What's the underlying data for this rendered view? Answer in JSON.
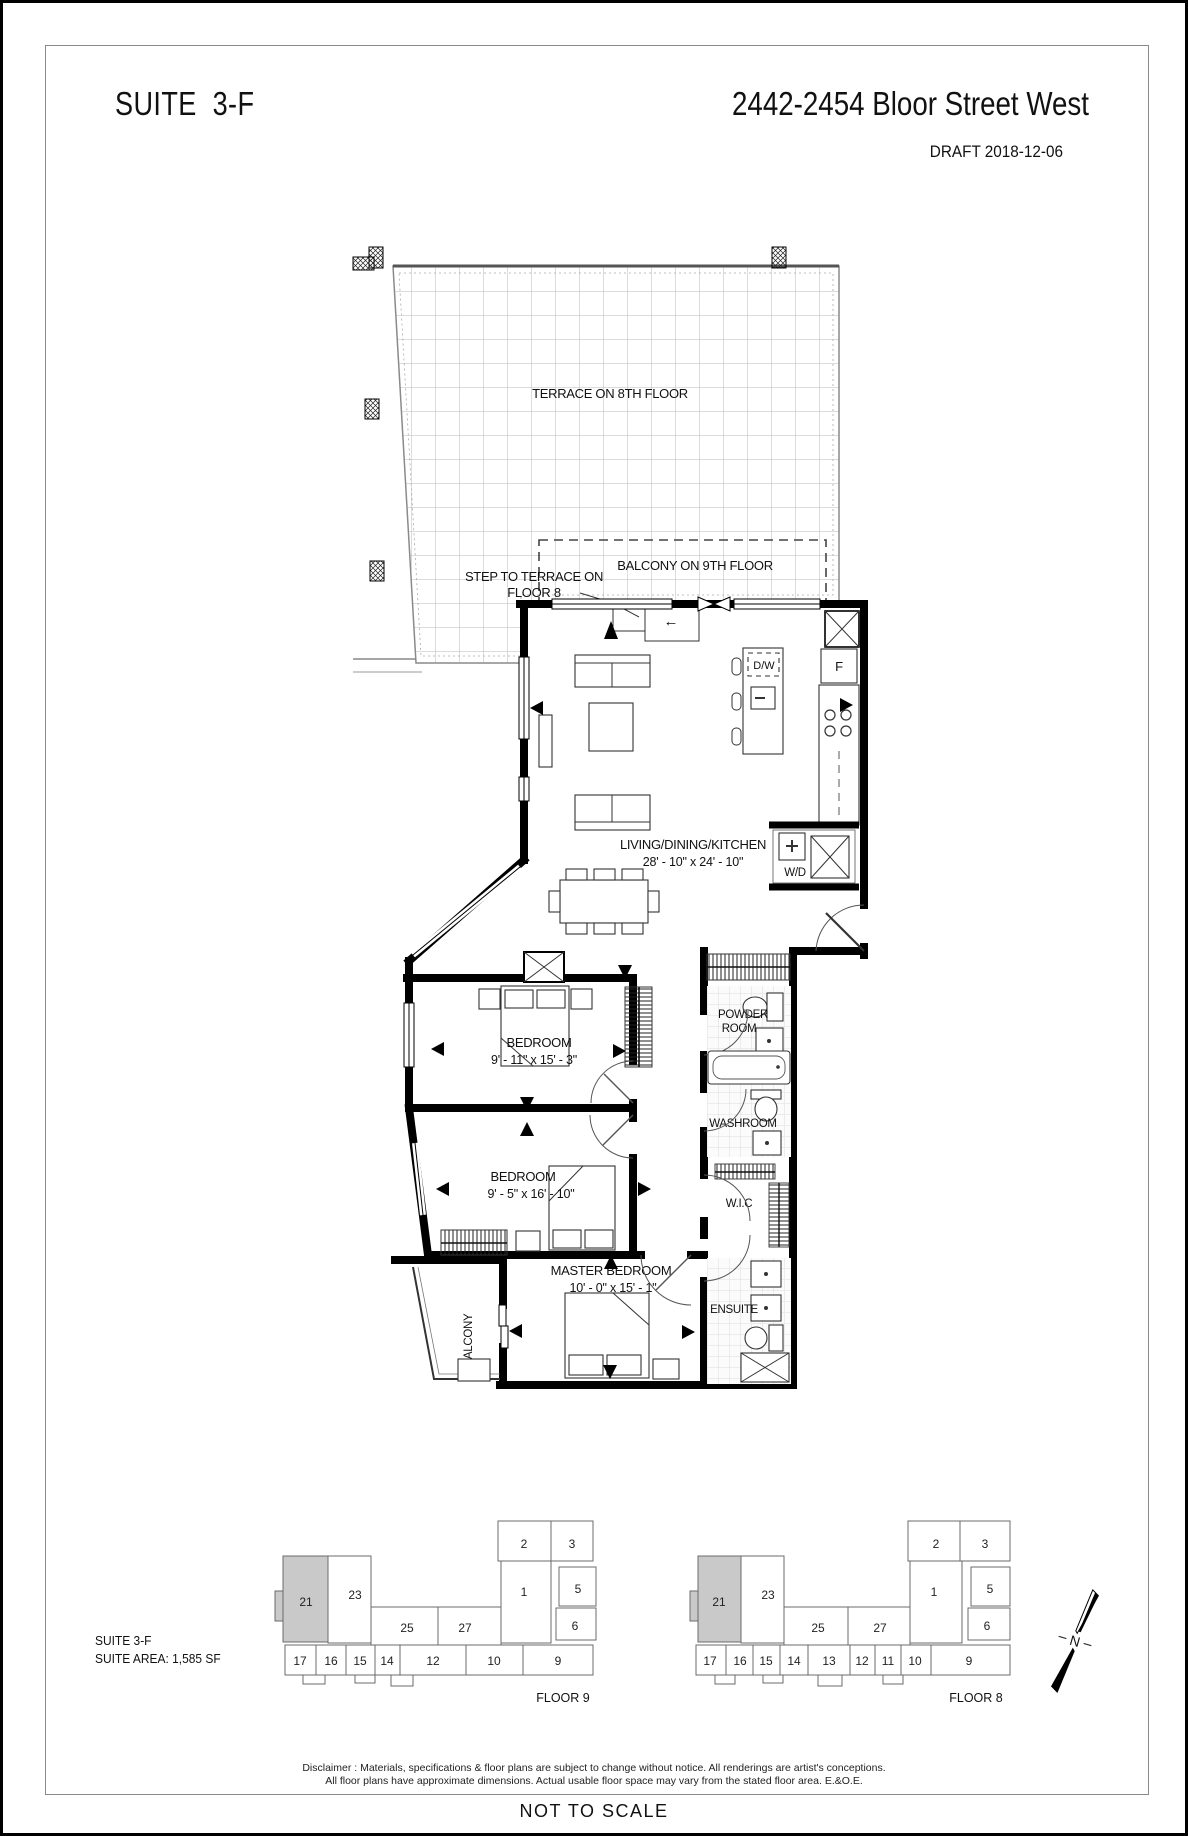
{
  "header": {
    "suite_title": "SUITE  3-F",
    "address": "2442-2454 Bloor Street West",
    "draft": "DRAFT 2018-12-06"
  },
  "plan": {
    "terrace": "TERRACE ON 8TH FLOOR",
    "balcony9": "BALCONY ON 9TH FLOOR",
    "step1": "STEP TO TERRACE ON",
    "step2": "FLOOR 8",
    "step_arrow": "←",
    "ldk": {
      "name": "LIVING/DINING/KITCHEN",
      "dims": "28' - 10\"  x  24' - 10\""
    },
    "bedroom1": {
      "name": "BEDROOM",
      "dims": "9' - 11\"  x  15' - 3\""
    },
    "bedroom2": {
      "name": "BEDROOM",
      "dims": "9' - 5\"  x  16' - 10\""
    },
    "master": {
      "name": "MASTER BEDROOM",
      "dims": "10' - 0\"  x  15' - 1\""
    },
    "powder1": "POWDER",
    "powder2": "ROOM",
    "washroom": "WASHROOM",
    "wic": "W.I.C",
    "ensuite": "ENSUITE",
    "balcony": "BALCONY",
    "dw": "D/W",
    "fridge": "F",
    "wd": "W/D"
  },
  "footer": {
    "suite": "SUITE 3-F",
    "area": "SUITE AREA: 1,585 SF",
    "highlight_color": "#c9c9c9",
    "north": "N",
    "floor9": {
      "label": "FLOOR 9",
      "units": {
        "u2": "2",
        "u3": "3",
        "u1": "1",
        "u5": "5",
        "u6": "6",
        "u21": "21",
        "u23": "23",
        "u25": "25",
        "u27": "27",
        "u17": "17",
        "u16": "16",
        "u15": "15",
        "u14": "14",
        "u12": "12",
        "u10": "10",
        "u9": "9"
      }
    },
    "floor8": {
      "label": "FLOOR 8",
      "units": {
        "u2": "2",
        "u3": "3",
        "u1": "1",
        "u5": "5",
        "u6": "6",
        "u21": "21",
        "u23": "23",
        "u25": "25",
        "u27": "27",
        "u17": "17",
        "u16": "16",
        "u15": "15",
        "u14": "14",
        "u13": "13",
        "u12": "12",
        "u11": "11",
        "u10": "10",
        "u9": "9"
      }
    }
  },
  "legal": {
    "disclaimer1": "Disclaimer : Materials, specifications & floor plans are subject to change without notice. All renderings are artist's conceptions.",
    "disclaimer2": "All floor plans  have approximate dimensions. Actual usable floor space may vary from the stated floor area. E.&O.E.",
    "not_to_scale": "NOT TO SCALE"
  }
}
